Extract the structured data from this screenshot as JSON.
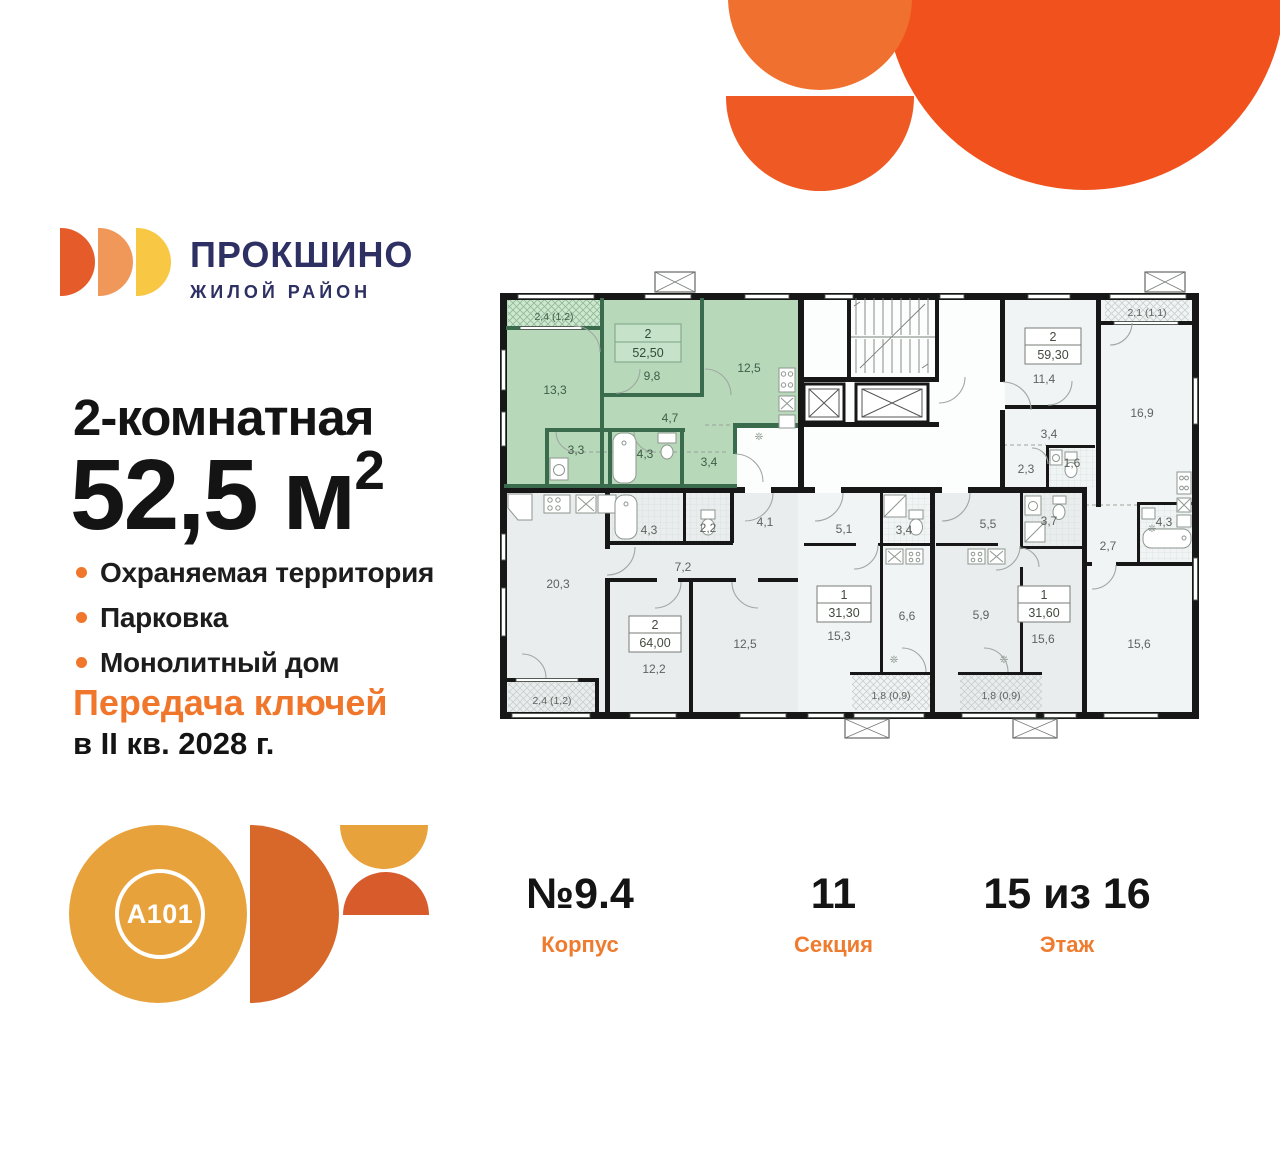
{
  "brand": {
    "name": "ПРОКШИНО",
    "tagline": "ЖИЛОЙ РАЙОН"
  },
  "offer": {
    "rooms_title": "2-комнатная",
    "area_value": "52,5 м",
    "area_sup": "2",
    "features": [
      "Охраняемая территория",
      "Парковка",
      "Монолитный дом"
    ],
    "keys_line1": "Передача ключей",
    "keys_line2": "в II кв. 2028 г."
  },
  "developer": {
    "logo_text": "A101"
  },
  "meta": {
    "building": {
      "value": "№9.4",
      "label": "Корпус"
    },
    "section": {
      "value": "11",
      "label": "Секция"
    },
    "floor": {
      "value": "15 из 16",
      "label": "Этаж"
    }
  },
  "plan": {
    "a1": {
      "rooms": "2",
      "area": "52,50",
      "balcony": "2,4 (1,2)",
      "living": "13,3",
      "bed": "9,8",
      "kitchen": "12,5",
      "hall": "4,7",
      "bath": "3,3",
      "bath2": "4,3",
      "hall2": "3,4"
    },
    "a2": {
      "rooms": "2",
      "area": "59,30",
      "balcony": "2,1 (1,1)",
      "r1": "11,4",
      "r2": "3,4",
      "r3": "2,3",
      "r4": "1,6",
      "r5": "16,9",
      "r6": "2,7",
      "r7": "4,3",
      "r8": "15,6"
    },
    "a3": {
      "rooms": "2",
      "area": "64,00",
      "balcony": "2,4 (1,2)",
      "r1": "20,3",
      "r2": "4,3",
      "r3": "2,2",
      "r4": "4,1",
      "r5": "7,2",
      "r6": "12,2",
      "r7": "12,5"
    },
    "a4": {
      "rooms": "1",
      "area": "31,30",
      "balcony": "1,8 (0,9)",
      "r1": "5,1",
      "r2": "3,4",
      "r3": "15,3",
      "r4": "6,6"
    },
    "a5": {
      "rooms": "1",
      "area": "31,60",
      "balcony": "1,8 (0,9)",
      "r1": "5,5",
      "r2": "3,7",
      "r3": "5,9",
      "r4": "15,6"
    }
  },
  "colors": {
    "accent_orange": "#F0762C",
    "brand_navy": "#2E3063",
    "highlight_green": "#B7D8B9",
    "decor_orange": "#F1521D"
  }
}
